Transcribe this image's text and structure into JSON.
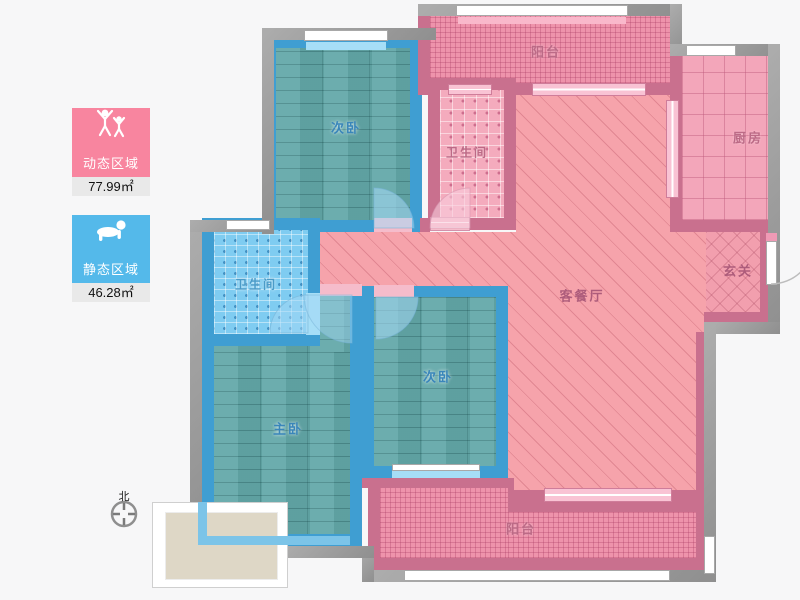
{
  "legend": {
    "dynamic": {
      "label": "动态区域",
      "value": "77.99",
      "unit": "㎡",
      "card_color": "#f8859f",
      "icon": "people-jumping-icon"
    },
    "static": {
      "label": "静态区域",
      "value": "46.28",
      "unit": "㎡",
      "card_color": "#54b9ea",
      "icon": "baby-crawling-icon"
    }
  },
  "compass": {
    "north_label": "北"
  },
  "rooms": {
    "bedroom_top": {
      "label": "次卧",
      "type": "bedroom"
    },
    "bath_top": {
      "label": "卫生间",
      "type": "bathroom"
    },
    "balcony_top": {
      "label": "阳台",
      "type": "balcony"
    },
    "kitchen": {
      "label": "厨房",
      "type": "kitchen"
    },
    "living": {
      "label": "客餐厅",
      "type": "living-dining"
    },
    "foyer": {
      "label": "玄关",
      "type": "entry"
    },
    "bath_mid": {
      "label": "卫生间",
      "type": "bathroom"
    },
    "master": {
      "label": "主卧",
      "type": "master-bedroom"
    },
    "bedroom_bottom": {
      "label": "次卧",
      "type": "bedroom"
    },
    "balcony_bottom": {
      "label": "阳台",
      "type": "balcony"
    }
  },
  "colors": {
    "background": "#f7f7f8",
    "outer_wall": "#9c9c9c",
    "pink_wall": "#c9708e",
    "blue_wall": "#3f9ed2",
    "living_fill": "#f6a3ab",
    "balcony_fill": "#ee93ab",
    "wood_fill": "#63a8a9",
    "bath_blue_fill": "#7fccf1",
    "bath_pink_fill": "#f4abbd",
    "kitchen_fill": "#f3a6ba"
  }
}
